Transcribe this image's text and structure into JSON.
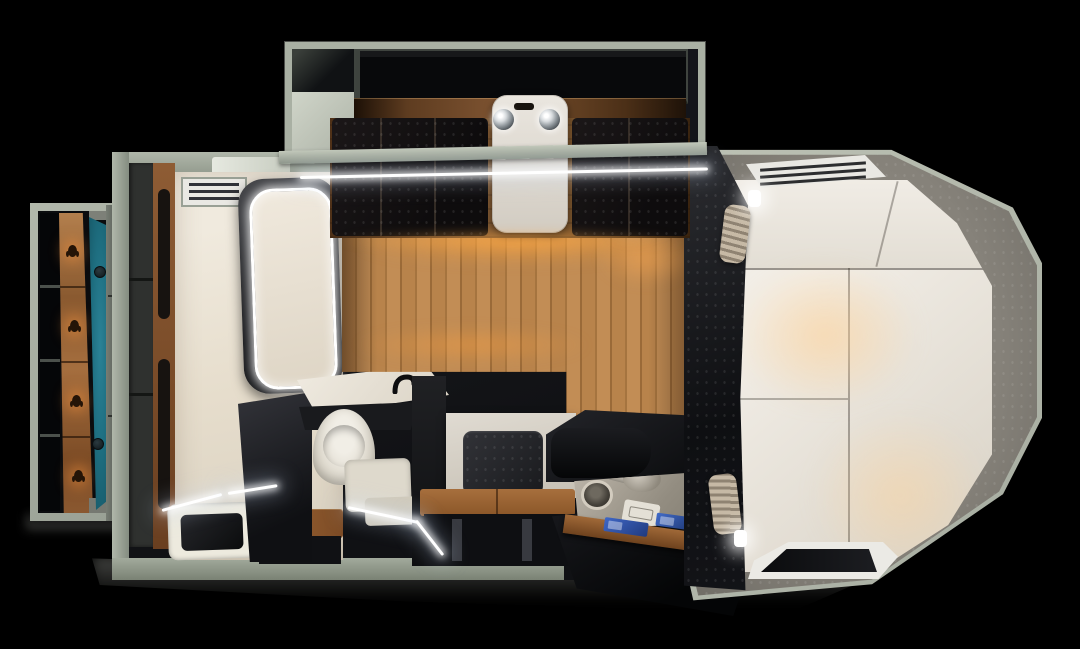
{
  "meta": {
    "title": "Truck camper interior floor plan — top-down 3D render",
    "view": "top-down"
  },
  "colors": {
    "bg": "#000000",
    "wall": "#a9b0a3",
    "wall-light": "#c8cec0",
    "wall-mid": "#8e968a",
    "wall-dark": "#5f655e",
    "charcoal": "#17181b",
    "charcoal-deep": "#0a0b0d",
    "charcoal-soft": "#2c2d31",
    "wood-floor": "#b8834b",
    "wood-floor-dark": "#9a6a38",
    "wood-trim": "#7a5130",
    "bench-wood": "#9c6434",
    "mattress": "#ede9e2",
    "mattress-shade": "#d8d2c6",
    "bath-white": "#ece6da",
    "carpet": "#8d8981",
    "carpet-dark": "#6e6b64",
    "teal": "#1e6e80",
    "teal-dark": "#14505e",
    "led": "#ffffff",
    "amber": "#ffa53c",
    "chrome": "#cdd2d5",
    "screen-blue": "#3f67c6",
    "screen-blue-deep": "#203a7e",
    "tray": "#b0a99d",
    "shadow-gray": "#7e807b"
  },
  "zones": {
    "slideout_dinette": "slide-out dinette",
    "overhead_lockers": "overhead lockers",
    "dinette_table": "dinette table",
    "dinette_seats": "facing bench seats",
    "spotlights": "chrome ceiling spotlights",
    "entry_wardrobe": "entry wardrobe with coat hooks",
    "teal_accent": "teal accent wall",
    "bathroom": "wet bathroom",
    "shower_pan": "shower pan with drain",
    "toilet": "toilet with steps",
    "vanity": "vanity with faucet",
    "step_stool": "wooden step stool",
    "tall_cabinet": "tall cabinet column",
    "appliance_cabinet": "appliance cabinet",
    "bench": "wooden storage bench",
    "galley": "pull-out galley with sink",
    "cooktop_screens": "blue control screens",
    "main_floor": "wood laminate floor",
    "corner_cabinet": "overhead corner cabinet",
    "cabover_bed": "cab-over double bed",
    "headboard": "headboard cushions",
    "carpet_deck": "gray carpet deck",
    "roof_vent": "louvered roof vent",
    "front_window": "front window",
    "partition": "bedroom partition",
    "curtains": "rolled curtains",
    "reading_lights": "reading lights",
    "led_strips": "LED light strips"
  }
}
